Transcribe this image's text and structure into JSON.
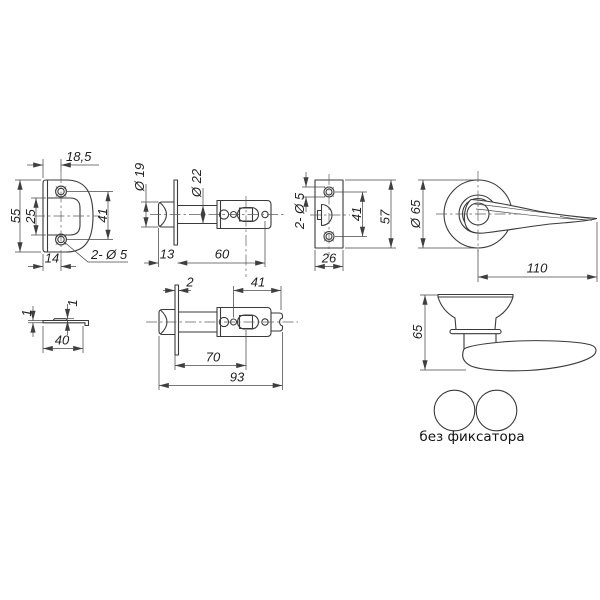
{
  "title": "door-latch-technical-drawing",
  "caption": "без фиксатора",
  "colors": {
    "background": "#ffffff",
    "outline": "#3a3a3a",
    "dimension": "#4a4a4a",
    "text": "#1f1f1f"
  },
  "dims": {
    "v1_width_top": "18,5",
    "v1_height": "55",
    "v1_window": "25",
    "v1_holes_spacing": "41",
    "v1_width_bottom": "14",
    "v1_holes": "2- Ø 5",
    "v2_bolt_dia": "Ø 19",
    "v2_body_dia": "Ø 22",
    "v2_head": "13",
    "v2_body_len": "60",
    "v3_holes": "2- Ø 5",
    "v3_holes_spacing": "41",
    "v3_height": "57",
    "v3_width": "26",
    "v4_rose_dia": "Ø 65",
    "v4_lever_len": "110",
    "v5_thickness": "1",
    "v5_tab": "1",
    "v5_width": "40",
    "v6_plate_thk": "2",
    "v6_tail": "41",
    "v6_backset": "70",
    "v6_total": "93",
    "v7_height": "65"
  }
}
